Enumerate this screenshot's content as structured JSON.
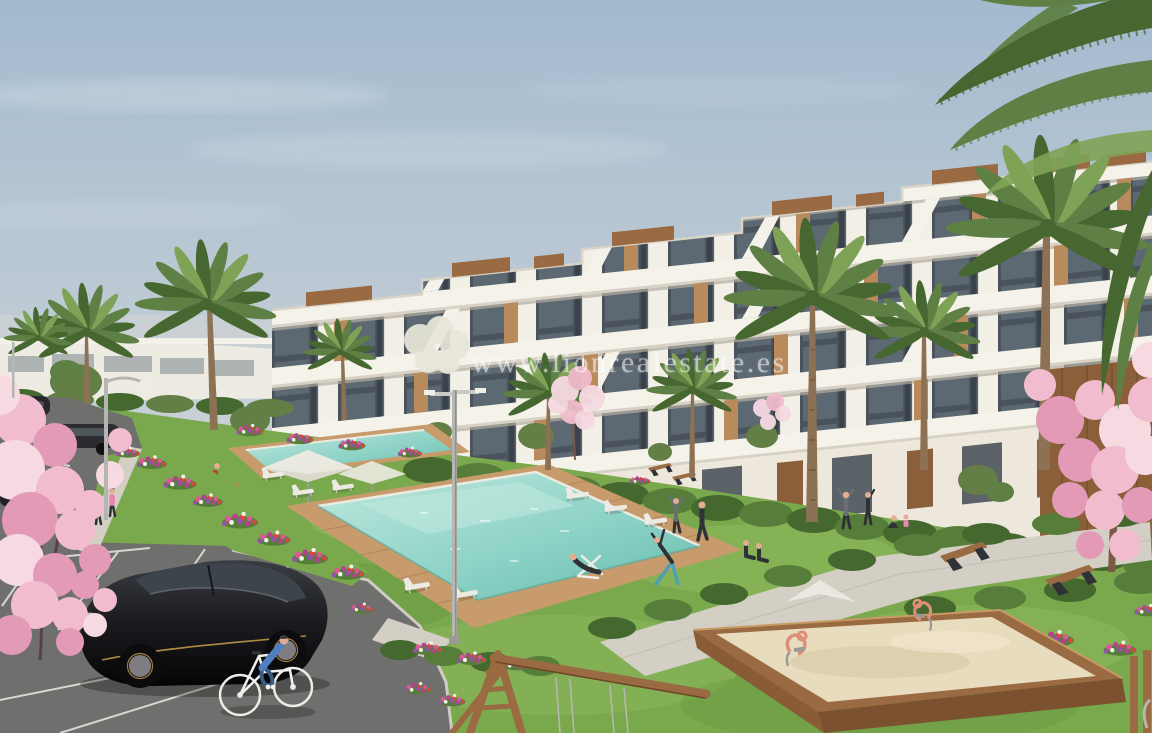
{
  "watermark": {
    "text": "www.lionrealestate.es"
  },
  "scene": {
    "objects": [
      "sky",
      "modern-terraced-apartment-buildings",
      "distant-low-buildings",
      "palm-trees",
      "cherry-blossom-trees",
      "flower-beds",
      "lawn",
      "swimming-pools",
      "wooden-pool-deck",
      "sun-loungers",
      "parasols",
      "street-lamps",
      "pedestrian-path",
      "park-benches",
      "hedges",
      "parking-lot",
      "black-hatchback-car",
      "parked-cars",
      "cyclist",
      "pedestrians",
      "people-exercising",
      "sunbather",
      "children-sandbox",
      "spring-rider-toys",
      "wooden-swing-frame",
      "watermark-text"
    ]
  },
  "palette": {
    "sky_top": "#a3bacf",
    "sky_mid": "#c6cfd6",
    "horizon": "#e5e0d5",
    "building_white": "#f5f2ea",
    "band_shadow": "#d8d2c6",
    "window_dark": "#4a535b",
    "window_glass": "#6b7a84",
    "window_frame": "#39424a",
    "wood": "#b98a5c",
    "wood_dark": "#8a5f39",
    "box_wood": "#9a6b42",
    "box_wood_dark": "#7c5130",
    "grass": "#7aa84d",
    "grass_light": "#95bf62",
    "grass_dark": "#5f9038",
    "hedge": "#44682e",
    "hedge_light": "#567e3a",
    "olive": "#637f46",
    "pool": "#8fd3c7",
    "pool_light": "#bfe8de",
    "pool_deep": "#66bcae",
    "deck": "#c79b6b",
    "deck_line": "#a87f52",
    "path": "#d3cfc5",
    "asphalt": "#6f6f6d",
    "line_white": "#e9e9e4",
    "kerb": "#cfccc4",
    "sand": "#e8dcbe",
    "sand_shade": "#d6c5a0",
    "blossom": "#f1bccd",
    "blossom_deep": "#e39ab6",
    "blossom_light": "#f7d9e2",
    "palm_green": "#5e8045",
    "palm_dark": "#46672f",
    "palm_light": "#7fa356",
    "trunk": "#8d7155",
    "car_black": "#1b1b1f",
    "car_glass": "#3e444b",
    "gold": "#c9a24a",
    "metal": "#b9b9b5",
    "white": "#eceae2",
    "skin": "#e2ad92",
    "dark": "#2e3237",
    "grey_cloth": "#6a6f74",
    "shirt_blue": "#4f7fc0",
    "teal": "#3fae9f",
    "red_shirt": "#c23b2e",
    "denim": "#3a5a80",
    "leggings": "#4aa0b5",
    "pink_cloth": "#e886b0",
    "toy_salmon": "#dd8f78",
    "flower_pink": "#e0559c",
    "flower_magenta": "#b93f92",
    "flower_red": "#d64747",
    "flower_purple": "#9a4fae",
    "flower_white": "#f2f2ec"
  }
}
